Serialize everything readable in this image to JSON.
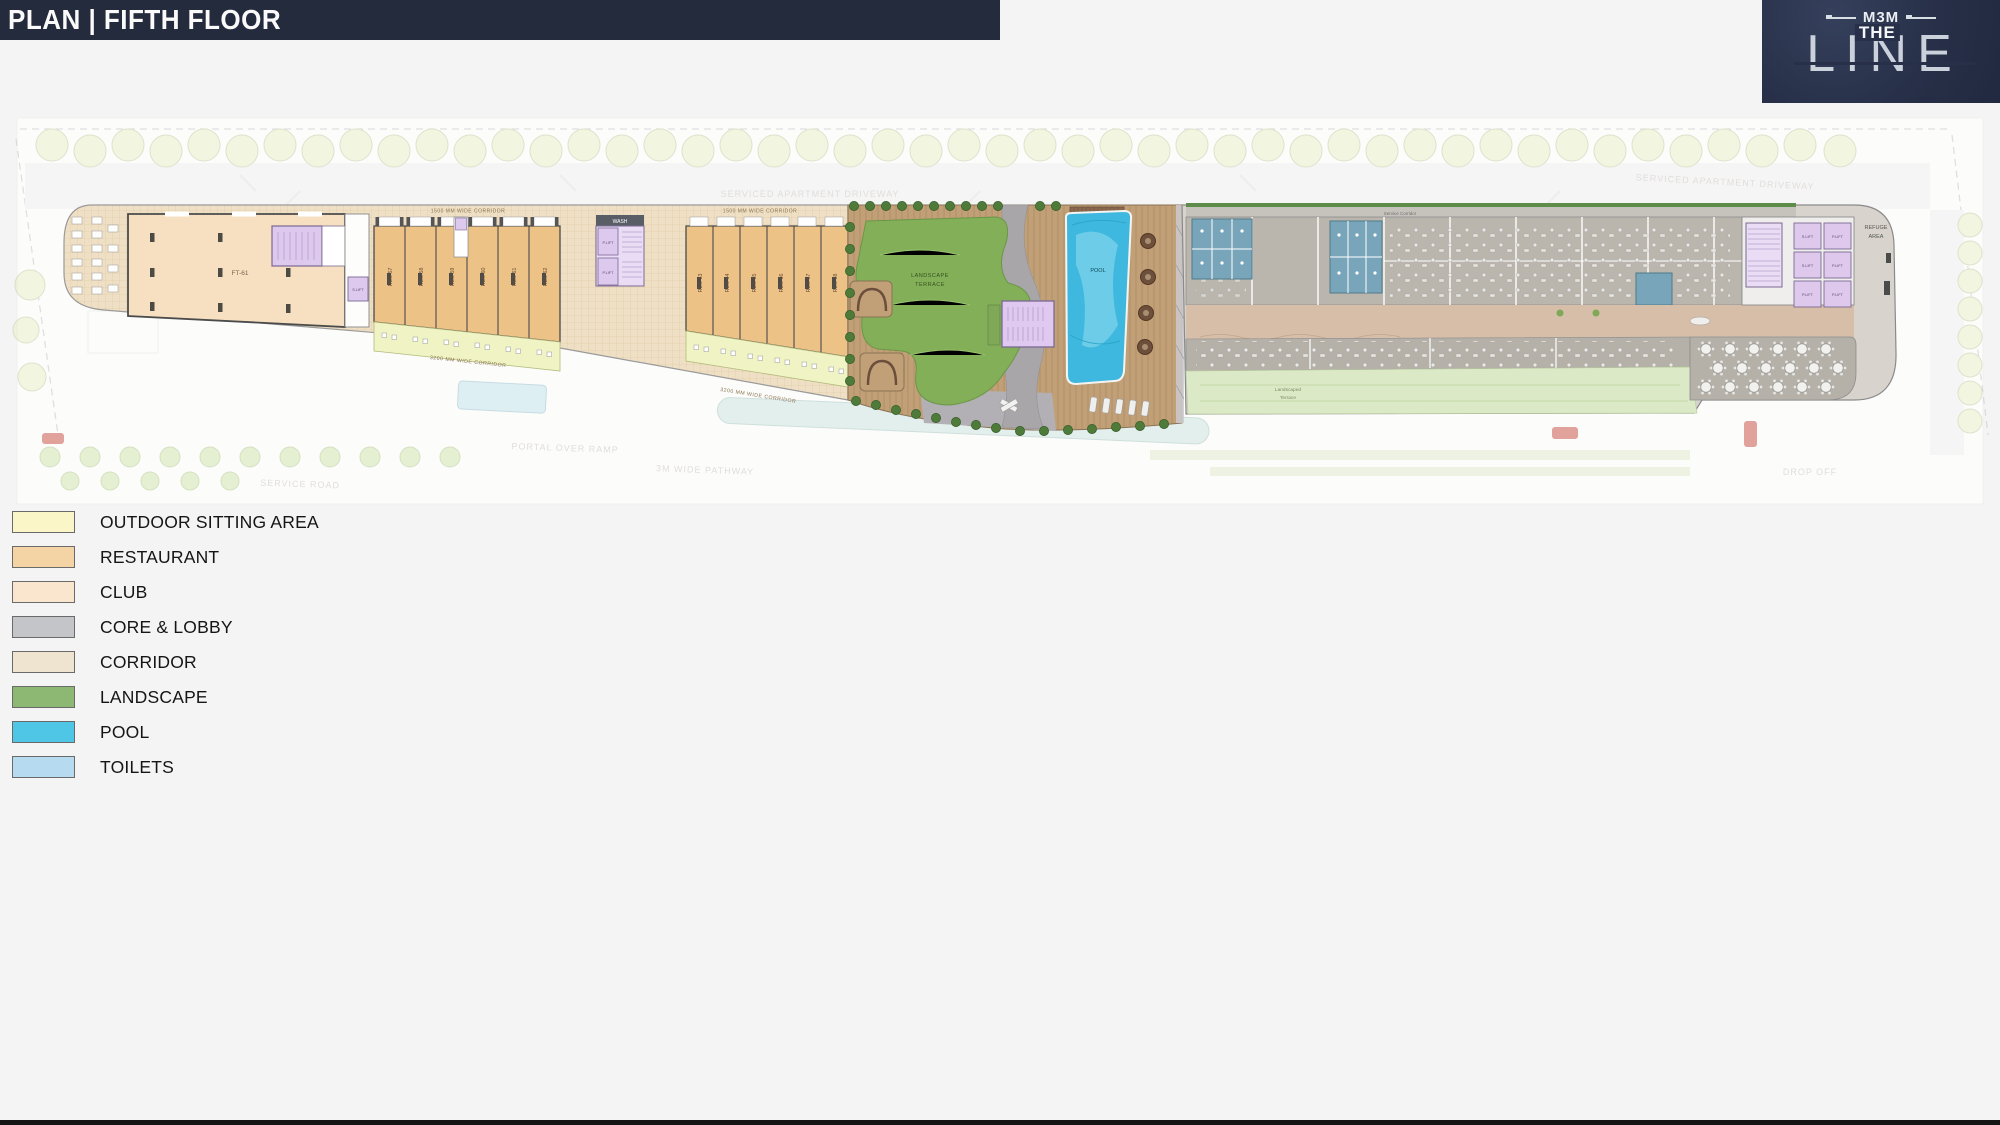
{
  "title_bar": {
    "title": "PLAN | FIFTH FLOOR"
  },
  "logo": {
    "brand": "M3M",
    "word_the": "THE",
    "word_line": "LINE"
  },
  "legend": {
    "items": [
      {
        "label": "OUTDOOR SITTING AREA",
        "color": "#FAF6C8"
      },
      {
        "label": "RESTAURANT",
        "color": "#F4D4A4"
      },
      {
        "label": "CLUB",
        "color": "#FAE6CE"
      },
      {
        "label": "CORE & LOBBY",
        "color": "#C3C5C8"
      },
      {
        "label": "CORRIDOR",
        "color": "#EEE4D0"
      },
      {
        "label": "LANDSCAPE",
        "color": "#8CB873"
      },
      {
        "label": "POOL",
        "color": "#4FC6E6"
      },
      {
        "label": "TOILETS",
        "color": "#B6DBF1"
      }
    ]
  },
  "plan": {
    "club_unit": "FT-61",
    "units_a": [
      "RES 57",
      "RES 58",
      "RES 59",
      "RES 60",
      "RES 61",
      "RES 62"
    ],
    "units_b": [
      "RES 63",
      "RES 64",
      "RES 65",
      "RES 66",
      "RES 67",
      "RES 68"
    ],
    "corridor_top": "1500 MM WIDE CORRIDOR",
    "corridor_bottom": "3200 MM WIDE CORRIDOR",
    "service_corridor": "Service Corridor",
    "wash": "WASH",
    "s_lift": "S.LIFT",
    "p_lift": "P.LIFT",
    "pool": "POOL",
    "landscape_terrace_1": "LANDSCAPE",
    "landscape_terrace_2": "TERRACE",
    "refuge_1": "REFUGE",
    "refuge_2": "AREA",
    "landscaped_1": "Landscaped",
    "landscaped_2": "Terrace",
    "site": {
      "driveway": "SERVICED APARTMENT DRIVEWAY",
      "ramp": "PORTAL OVER RAMP",
      "pathway": "3M WIDE PATHWAY",
      "service_road": "SERVICE ROAD",
      "drop_off": "DROP OFF"
    }
  }
}
